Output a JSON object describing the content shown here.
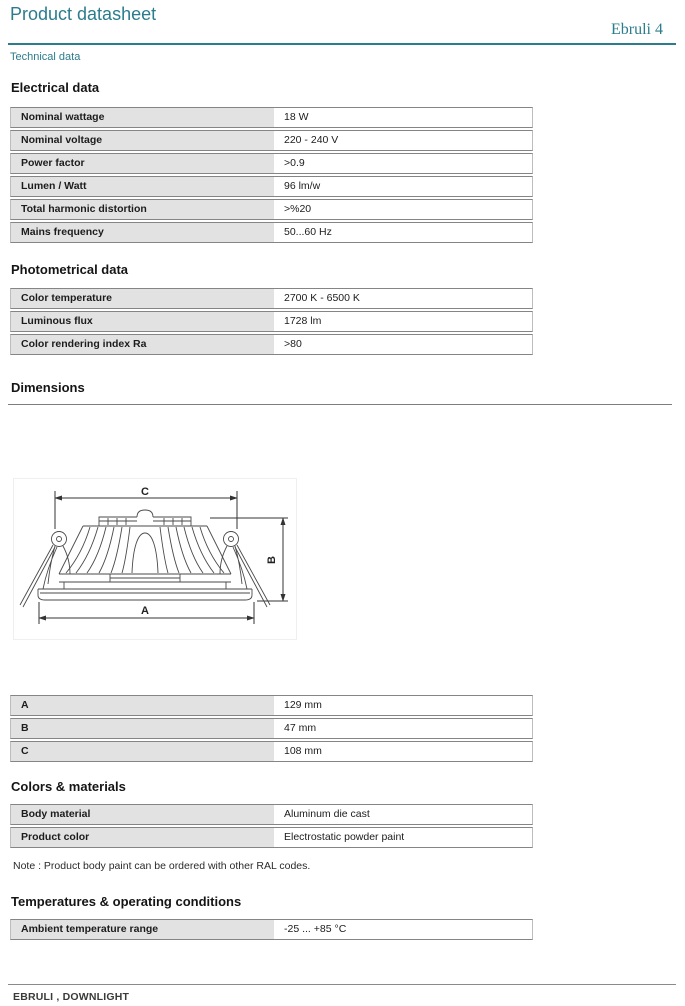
{
  "header": {
    "title": "Product datasheet",
    "product_name": "Ebruli 4",
    "subtitle": "Technical data"
  },
  "sections": {
    "electrical": {
      "heading": "Electrical data",
      "rows": [
        {
          "label": "Nominal wattage",
          "value": "18 W"
        },
        {
          "label": "Nominal voltage",
          "value": "220 - 240 V"
        },
        {
          "label": "Power factor",
          "value": ">0.9"
        },
        {
          "label": "Lumen / Watt",
          "value": "96 lm/w"
        },
        {
          "label": "Total harmonic distortion",
          "value": ">%20"
        },
        {
          "label": "Mains frequency",
          "value": "50...60 Hz"
        }
      ]
    },
    "photometrical": {
      "heading": "Photometrical data",
      "rows": [
        {
          "label": "Color temperature",
          "value": "2700 K - 6500 K"
        },
        {
          "label": "Luminous flux",
          "value": "1728 lm"
        },
        {
          "label": "Color rendering index Ra",
          "value": ">80"
        }
      ]
    },
    "dimensions": {
      "heading": "Dimensions",
      "drawing_labels": {
        "a": "A",
        "b": "B",
        "c": "C"
      },
      "rows": [
        {
          "label": "A",
          "value": "129 mm"
        },
        {
          "label": "B",
          "value": "47 mm"
        },
        {
          "label": "C",
          "value": "108 mm"
        }
      ]
    },
    "colors_materials": {
      "heading": "Colors & materials",
      "rows": [
        {
          "label": "Body material",
          "value": "Aluminum die cast"
        },
        {
          "label": "Product color",
          "value": "Electrostatic powder paint"
        }
      ],
      "note": "Note : Product body paint can be ordered with  other RAL codes."
    },
    "temperatures": {
      "heading": "Temperatures & operating conditions",
      "rows": [
        {
          "label": "Ambient temperature range",
          "value": "-25 ... +85 °C"
        }
      ]
    }
  },
  "footer": {
    "text": "EBRULI , DOWNLIGHT"
  },
  "colors": {
    "accent_teal": "#2b7c8c",
    "table_label_bg": "#e2e2e2",
    "rule_gray": "#7d7d7d"
  }
}
